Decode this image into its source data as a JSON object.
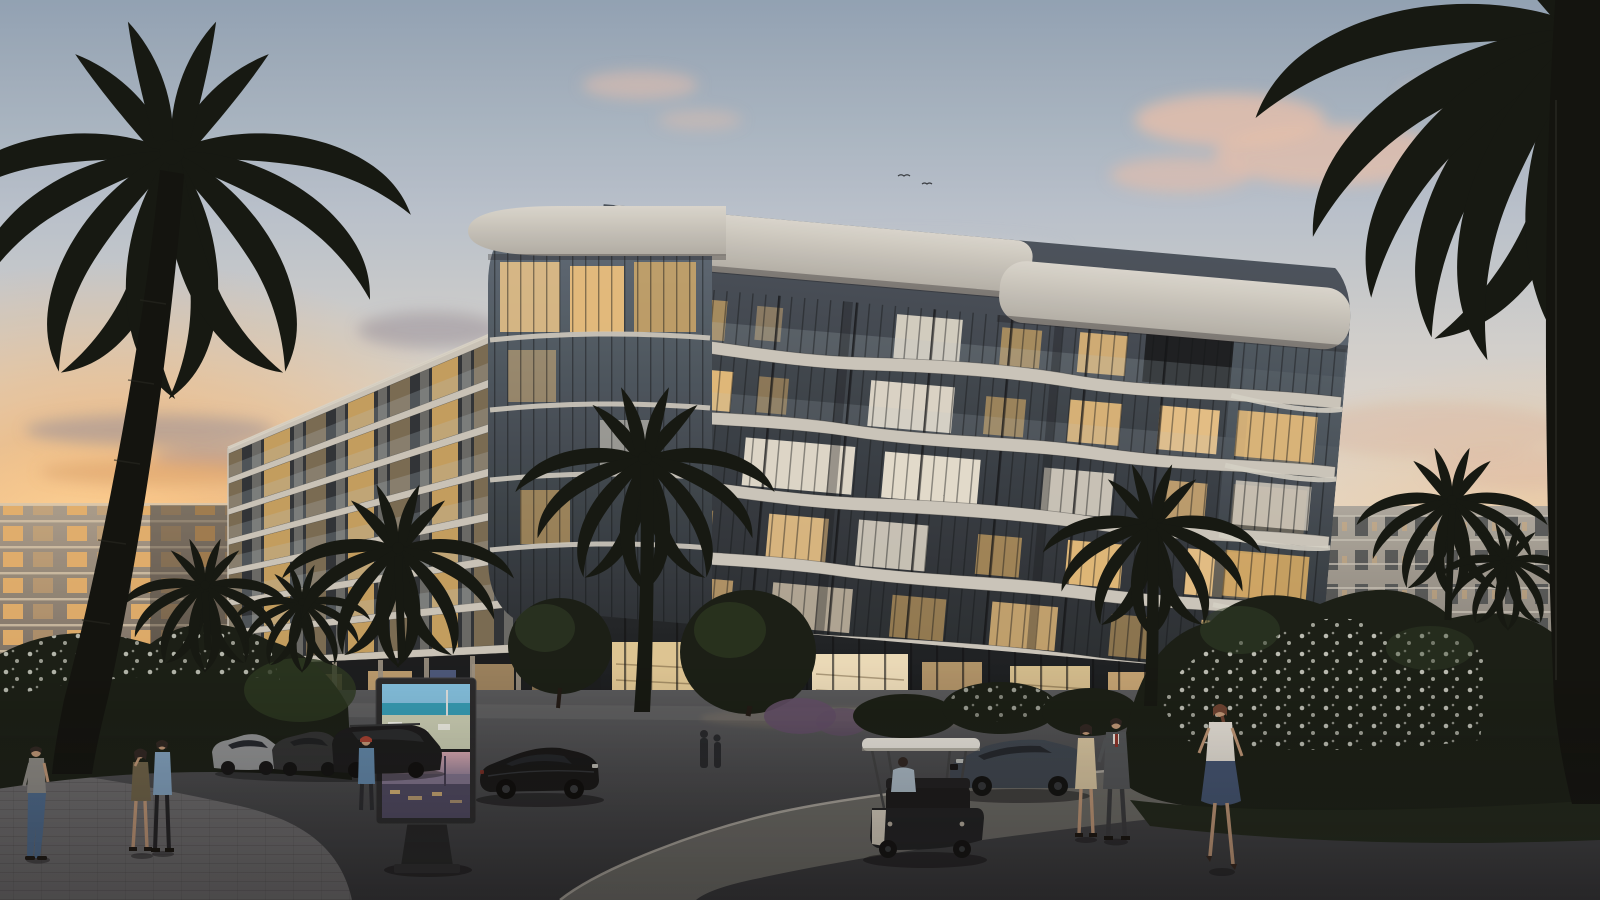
{
  "scene": {
    "subject": "curved-glass-apartment-building-at-dusk",
    "time_of_day": "dusk",
    "billboard_panels": [
      "daytime-aerial-city-by-sea",
      "dusk-aerial-city-lights"
    ],
    "vehicle_inventory": [
      "golf-cart",
      "dark-sedan",
      "black-sports-car",
      "black-suv",
      "silver-sedan",
      "grey-sedan"
    ],
    "people_count": 9,
    "palm_tree_count": 10
  },
  "colors": {
    "skyTop": "#8fa2b6",
    "skyMid": "#b7c2cf",
    "skyLow": "#d8d5d0",
    "skyHorizon": "#e7dccb",
    "sunsetGlow": "#f5b269",
    "sunsetHot": "#ffd9a2",
    "cloudPink": "#e6c0ae",
    "cloudGrey": "#98909b",
    "cloudWarm": "#dca46e",
    "bgFacade": "#a89c8c",
    "bgSlabLine": "#d8c8ae",
    "bgWinWarm": "#eab269",
    "bgRightFacade": "#aba79f",
    "bgRightSlot": "#3c4246",
    "concreteCap": "#d9d7d0",
    "concreteCapDark": "#aeaca6",
    "slabLight": "#c9c6be",
    "wingSlab": "#c8c4ba",
    "wingGlassBase": "#2a3036",
    "pierLight": "#b5b1a7",
    "glassTop": "#46505c",
    "glassBot": "#20262c",
    "prowTop": "#5d6b79",
    "prowBot": "#262d34",
    "warm": "#f2c580",
    "warmBright": "#f6cd8d",
    "warmDeep": "#e8b869",
    "intWhite": "#ece6d7",
    "terraceDark": "#161b20",
    "railGlass": "#b9c7d1",
    "storeDark": "#1d2227",
    "storeGlowA": "#f3d9a2",
    "storeGlowB": "#f7e7c4",
    "storeGlowC": "#eec488",
    "groundTop": "#53565b",
    "groundBot": "#2c2f34",
    "pathLight": "#6b6d69",
    "curb": "#b7b4ab",
    "brick": "#68696d",
    "walk": "#5f6266",
    "bushDark": "#131a13",
    "bushMid": "#26351f",
    "bushLight": "#2c3b27",
    "purpleBush": "#5c4a66",
    "flower": "#d7dbd2",
    "grassDark": "#1a2318",
    "palm": "#0e130f",
    "trunk": "#141713",
    "trunkDark": "#0b0e0c",
    "bbFrame": "#24262a",
    "bbDaySky": "#7fc0e2",
    "bbDaySea": "#2f9cb8",
    "bbDayCity": "#c9cfb6",
    "bbDuskSkyTop": "#d8a9b4",
    "bbDuskSkyBot": "#8e7f9b",
    "bbDuskWater": "#7e7390",
    "bbDuskCity": "#4a4662",
    "bbLit": "#e8c27a",
    "carSilver": "#8e9296",
    "carGrey": "#2b2e31",
    "carSuv": "#141619",
    "carPorsche": "#101214",
    "carBmw": "#39434f",
    "glassTint": "#1d232b",
    "rim": "#3a3f45",
    "cartCanopy": "#e9e7e1",
    "cartBody": "#191c20",
    "cartSeat": "#141518",
    "cartPanel": "#d8d2c4",
    "skin": "#c09879",
    "hair": "#2a2220",
    "shirtGrey": "#8b8b88",
    "jeans": "#49698f",
    "jacketBlue": "#7fa3c4",
    "capRed": "#a33c2f",
    "oliveDress": "#6b6148",
    "navyJacket": "#5d87ad",
    "suit": "#4e5358",
    "tie": "#8a3028",
    "cream": "#d9c8a4",
    "blouse": "#e6e3dc",
    "skirt": "#3e5273",
    "ponytail": "#6a4030"
  }
}
